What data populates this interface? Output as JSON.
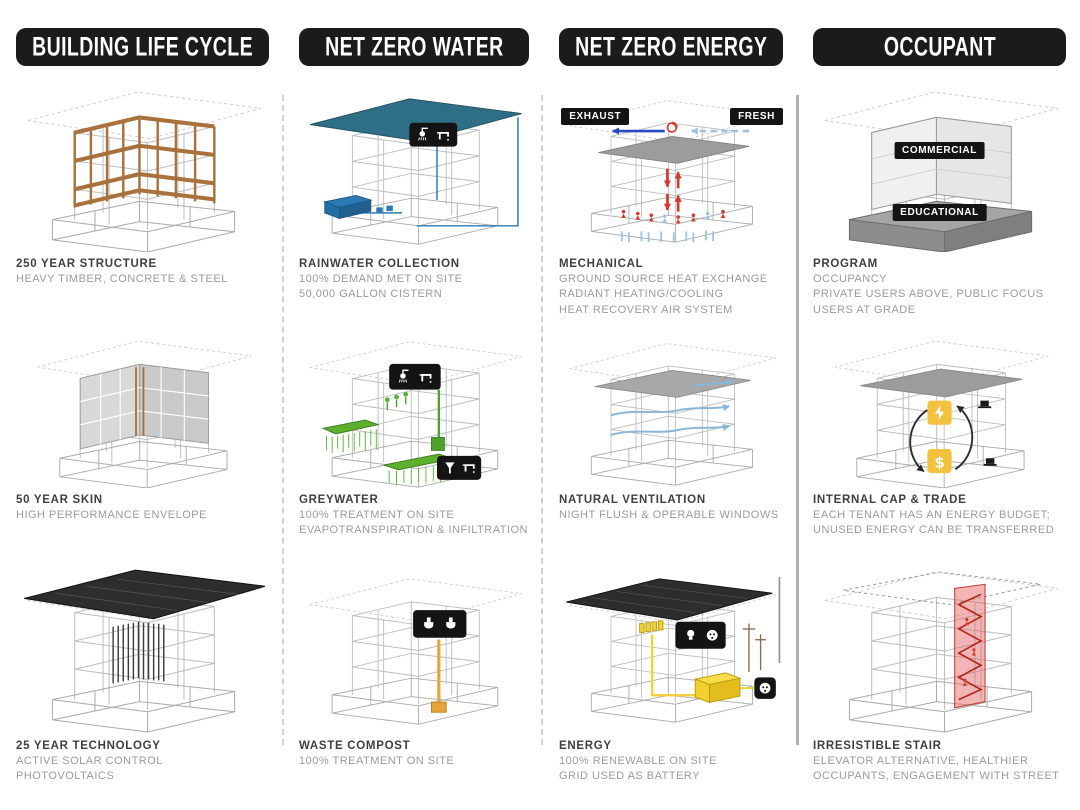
{
  "title": "Building sustainability strategies diagram",
  "colors": {
    "header_bg": "#1b1b1b",
    "timber_brown": "#a9713c",
    "water_blue": "#2a7ab5",
    "roof_teal": "#2e6f86",
    "greywater_green": "#57b32e",
    "mechanical_red": "#d23b2f",
    "fresh_air_blue": "#9cc3e4",
    "trade_yellow": "#f0c23e",
    "energy_yellow": "#f2d12e",
    "stair_red": "#e25b5b",
    "caption_title": "#3f3f3f",
    "caption_body": "#9b9b9b"
  },
  "columns": [
    {
      "header": "BUILDING LIFE CYCLE",
      "cells": [
        {
          "illustration": "timber-frame-structure",
          "title": "250 YEAR STRUCTURE",
          "lines": [
            "HEAVY TIMBER, CONCRETE & STEEL"
          ]
        },
        {
          "illustration": "high-performance-envelope",
          "title": "50 YEAR SKIN",
          "lines": [
            "HIGH PERFORMANCE ENVELOPE"
          ]
        },
        {
          "illustration": "solar-control-photovoltaics",
          "title": "25 YEAR TECHNOLOGY",
          "lines": [
            "ACTIVE SOLAR CONTROL",
            "PHOTOVOLTAICS"
          ]
        }
      ]
    },
    {
      "header": "NET ZERO WATER",
      "cells": [
        {
          "illustration": "rainwater-collection-cistern",
          "title": "RAINWATER COLLECTION",
          "lines": [
            "100% DEMAND MET ON SITE",
            "50,000 GALLON CISTERN"
          ]
        },
        {
          "illustration": "greywater-treatment",
          "title": "GREYWATER",
          "lines": [
            "100% TREATMENT ON SITE",
            "EVAPOTRANSPIRATION & INFILTRATION"
          ]
        },
        {
          "illustration": "waste-compost",
          "title": "WASTE COMPOST",
          "lines": [
            "100% TREATMENT ON SITE"
          ]
        }
      ]
    },
    {
      "header": "NET ZERO ENERGY",
      "cells": [
        {
          "illustration": "mechanical-air-system",
          "title": "MECHANICAL",
          "lines": [
            "GROUND SOURCE HEAT EXCHANGE",
            "RADIANT HEATING/COOLING",
            "HEAT RECOVERY AIR SYSTEM"
          ],
          "labels": {
            "exhaust": "EXHAUST",
            "fresh": "FRESH"
          }
        },
        {
          "illustration": "natural-ventilation-airflow",
          "title": "NATURAL VENTILATION",
          "lines": [
            "NIGHT FLUSH & OPERABLE WINDOWS"
          ]
        },
        {
          "illustration": "renewable-energy-grid",
          "title": "ENERGY",
          "lines": [
            "100% RENEWABLE ON SITE",
            "GRID USED AS BATTERY"
          ]
        }
      ]
    },
    {
      "header": "OCCUPANT",
      "cells": [
        {
          "illustration": "program-massing",
          "title": "PROGRAM",
          "lines": [
            "OCCUPANCY",
            "PRIVATE USERS ABOVE, PUBLIC FOCUS",
            "USERS AT GRADE"
          ],
          "labels": {
            "commercial": "COMMERCIAL",
            "educational": "EDUCATIONAL"
          }
        },
        {
          "illustration": "internal-cap-and-trade",
          "title": "INTERNAL CAP & TRADE",
          "lines": [
            "EACH TENANT HAS AN ENERGY BUDGET;",
            "UNUSED ENERGY CAN BE TRANSFERRED"
          ]
        },
        {
          "illustration": "irresistible-stair",
          "title": "IRRESISTIBLE STAIR",
          "lines": [
            "ELEVATOR ALTERNATIVE, HEALTHIER",
            "OCCUPANTS, ENGAGEMENT WITH STREET"
          ]
        }
      ]
    }
  ]
}
